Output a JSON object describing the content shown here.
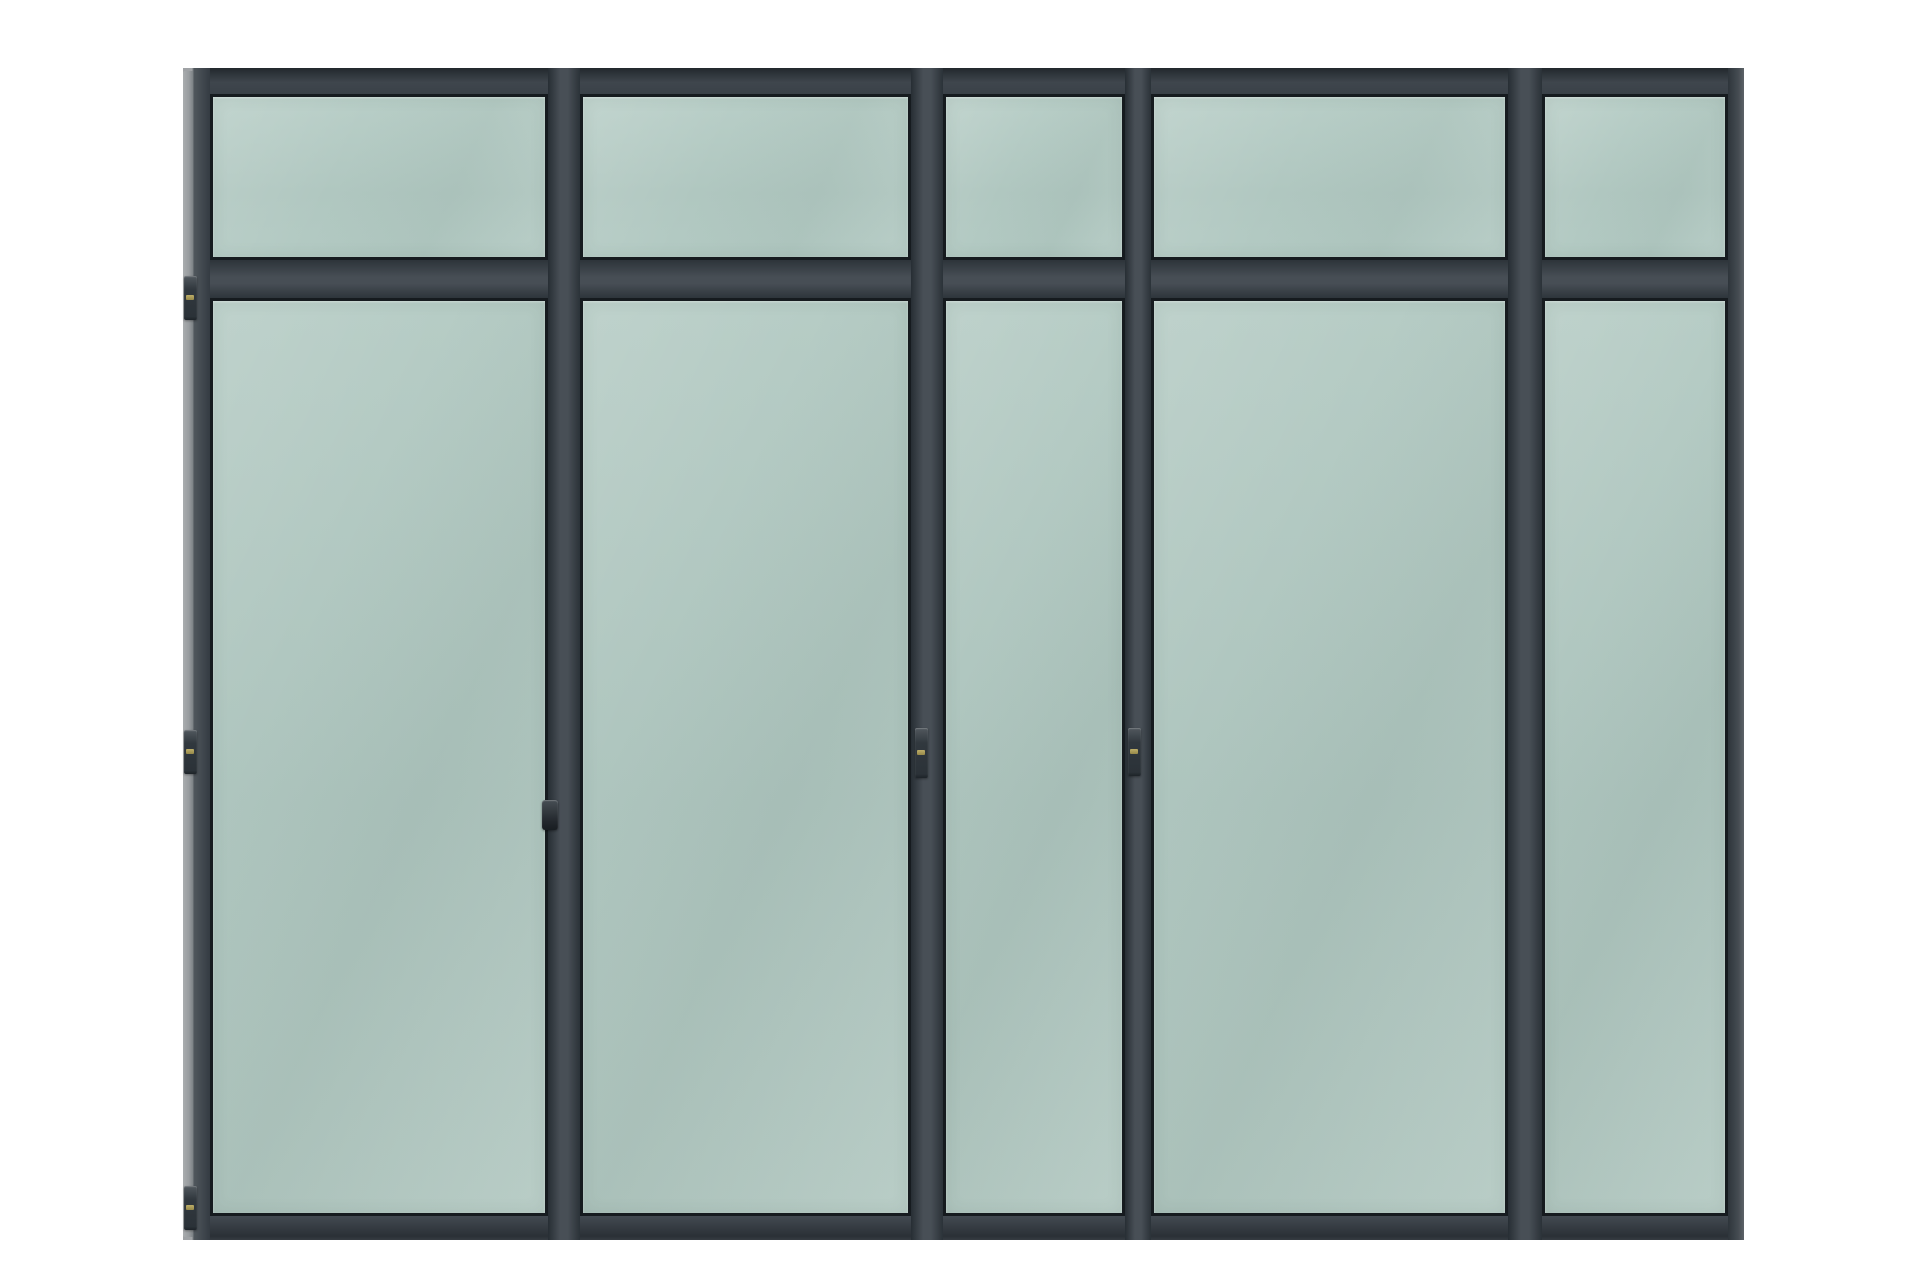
{
  "image": {
    "subject": "steel-framed-glass-partition-wall",
    "background_color": "#ffffff"
  },
  "wall": {
    "colors": {
      "frame": "#3c434a",
      "glazing_line": "#161b1f",
      "outer_bevel": "#9fa2a5",
      "glass": "#b0c7c0",
      "glass_highlight": "#b8cec7",
      "hardware": "#31383e",
      "hinge_pin": "#a89a55"
    },
    "structure": {
      "bays": 5,
      "rows": [
        "transom",
        "main"
      ]
    },
    "panes": [
      {
        "id": "transom-pane-1",
        "row": "transom",
        "col": 1
      },
      {
        "id": "transom-pane-2",
        "row": "transom",
        "col": 2
      },
      {
        "id": "transom-pane-3",
        "row": "transom",
        "col": 3
      },
      {
        "id": "transom-pane-4",
        "row": "transom",
        "col": 4
      },
      {
        "id": "transom-pane-5",
        "row": "transom",
        "col": 5
      },
      {
        "id": "main-pane-1",
        "row": "main",
        "col": 1
      },
      {
        "id": "main-pane-2",
        "row": "main",
        "col": 2
      },
      {
        "id": "main-pane-3",
        "row": "main",
        "col": 3
      },
      {
        "id": "main-pane-4",
        "row": "main",
        "col": 4
      },
      {
        "id": "main-pane-5",
        "row": "main",
        "col": 5
      }
    ],
    "hardware": [
      {
        "id": "hinge-left-jamb-top",
        "type": "hinge",
        "location": "left-jamb-top"
      },
      {
        "id": "hinge-left-jamb-middle",
        "type": "hinge",
        "location": "left-jamb-middle"
      },
      {
        "id": "hinge-left-jamb-bottom",
        "type": "hinge",
        "location": "left-jamb-bottom"
      },
      {
        "id": "hinge-mullion-2-middle",
        "type": "hinge",
        "location": "mullion-2-middle"
      },
      {
        "id": "hinge-mullion-3-middle",
        "type": "hinge",
        "location": "mullion-3-middle"
      },
      {
        "id": "door-handle-pane-1",
        "type": "handle",
        "location": "pane-1-right-stile"
      }
    ]
  }
}
